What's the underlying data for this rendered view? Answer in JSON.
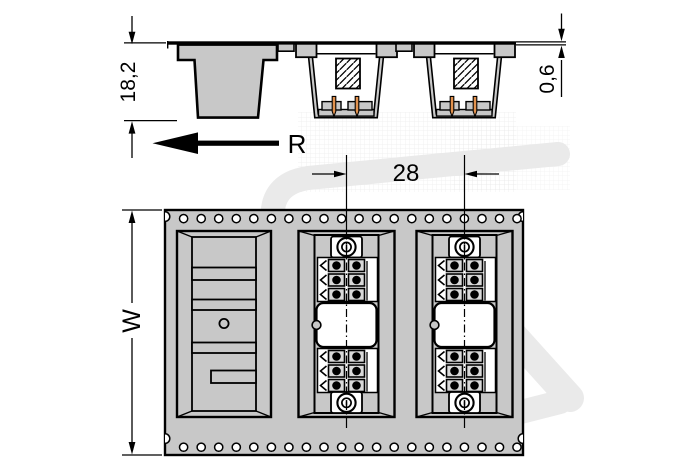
{
  "drawing": {
    "labels": {
      "pocket_depth": "18,2",
      "tape_thickness": "0,6",
      "pitch": "28",
      "tape_width": "W",
      "unreel_direction": "R"
    },
    "side_view": {
      "pockets": 3,
      "empty_pockets": 1,
      "loaded_pockets": 2,
      "pins_per_connector_visible": 2
    },
    "plan_view": {
      "sprocket_holes_per_row": 20,
      "sprocket_hole_rows": 2,
      "pockets": 3,
      "empty_pockets": 1,
      "loaded_pockets": 2,
      "contact_blocks_per_connector": 2,
      "contact_rows_per_block": 3,
      "contact_cols_per_block": 2
    },
    "colors": {
      "background": "#ffffff",
      "line": "#000000",
      "tape_gray": "#c8c8c8",
      "contact_cell_gray": "#d9d9d9",
      "pin_orange": "#e2914d",
      "watermark_gray": "#eaeaea"
    }
  }
}
